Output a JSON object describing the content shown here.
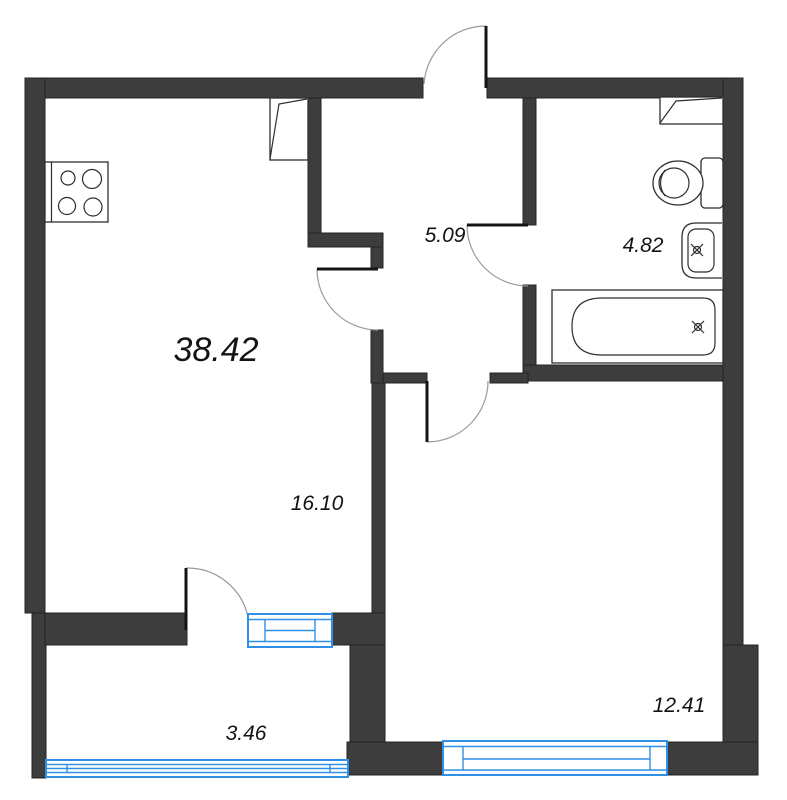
{
  "plan": {
    "total_area_label": "38.42",
    "rooms": [
      {
        "name": "kitchen-living-room",
        "area_label": "16.10"
      },
      {
        "name": "hallway",
        "area_label": "5.09"
      },
      {
        "name": "bathroom",
        "area_label": "4.82"
      },
      {
        "name": "bedroom",
        "area_label": "12.41"
      },
      {
        "name": "balcony",
        "area_label": "3.46"
      }
    ],
    "fixtures": [
      "stove-icon",
      "vent-shaft-icon-living",
      "vent-shaft-icon-bathroom",
      "toilet-icon",
      "sink-icon",
      "bathtub-icon"
    ],
    "colors": {
      "wall": "#3d3d3d",
      "outline": "#2e2e2e",
      "window": "#2f90e5",
      "door_arc": "#9a9a9a",
      "background": "#ffffff",
      "text": "#131313"
    }
  }
}
